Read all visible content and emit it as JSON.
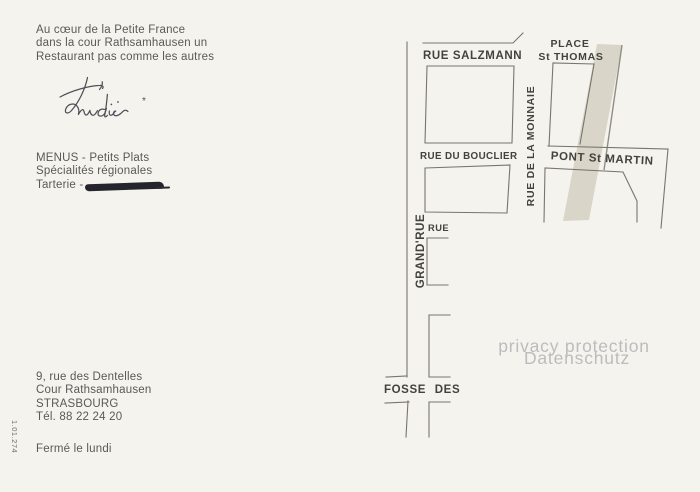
{
  "postcard": {
    "background_color": "#f5f3ee",
    "intro_lines": [
      "Au cœur de la Petite France",
      "dans la cour Rathsamhausen un",
      "Restaurant pas comme les autres"
    ],
    "signature": {
      "name": "Trudie",
      "mark": "*"
    },
    "menu_lines": [
      "MENUS - Petits Plats",
      "Spécialités régionales",
      "Tarterie -"
    ],
    "address_lines": [
      "9, rue des Dentelles",
      "Cour Rathsamhausen",
      "STRASBOURG",
      "Tél. 88 22 24 20"
    ],
    "closed_note": "Fermé le lundi",
    "catalog_number": "1.01.274"
  },
  "map": {
    "street_labels": {
      "rue_salzmann": "RUE SALZMANN",
      "place": "PLACE",
      "st_thomas": "St THOMAS",
      "rue_du_bouclier": "RUE DU BOUCLIER",
      "rue_de_la_monnaie": "RUE DE LA MONNAIE",
      "pont_st_martin": "PONT St MARTIN",
      "grand_rue": "GRAND'RUE",
      "rue": "RUE",
      "fosse_des": "FOSSE DES"
    },
    "colors": {
      "street_line": "#77756d",
      "river_band": "#d9d5c9",
      "river_band_edge": "#908e84",
      "label_text": "#44423d"
    }
  },
  "watermark": {
    "line1": "privacy protection",
    "line2": "Datenschutz",
    "color": "#bcbcbc"
  }
}
